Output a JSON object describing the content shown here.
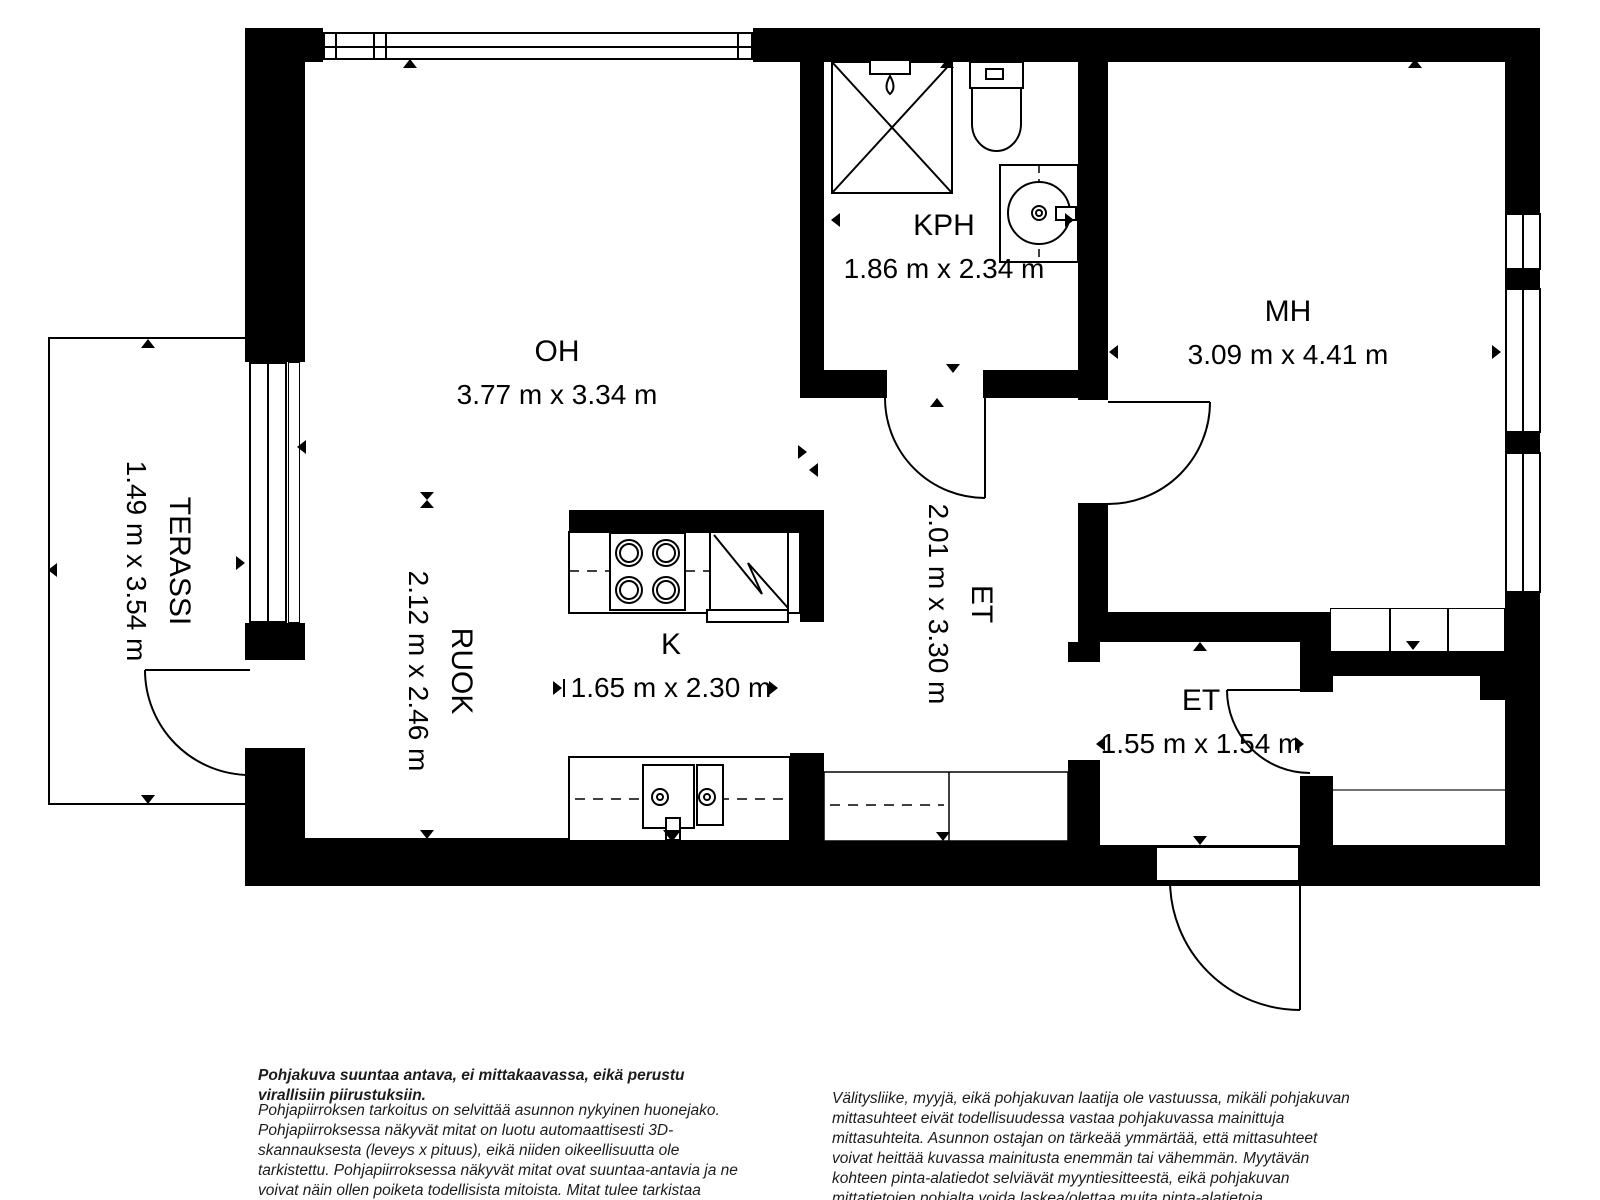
{
  "plan": {
    "rooms": {
      "oh": {
        "name": "OH",
        "dims": "3.77 m x 3.34 m"
      },
      "kph": {
        "name": "KPH",
        "dims": "1.86 m x 2.34 m"
      },
      "mh": {
        "name": "MH",
        "dims": "3.09 m x 4.41 m"
      },
      "terassi": {
        "name": "TERASSI",
        "dims": "1.49 m x 3.54 m"
      },
      "ruok": {
        "name": "RUOK",
        "dims": "2.12 m x 2.46 m"
      },
      "k": {
        "name": "K",
        "dims": "1.65 m x 2.30 m"
      },
      "et": {
        "name": "ET",
        "dims": "2.01 m x 3.30 m"
      },
      "et2": {
        "name": "ET",
        "dims": "1.55 m x 1.54 m"
      }
    },
    "fixtures": [
      "shower-icon",
      "toilet-icon",
      "washing-machine-icon",
      "stove-icon",
      "fridge-icon",
      "kitchen-sink-icon",
      "wardrobe-icon",
      "window-icon",
      "door-arc-icon",
      "measurement-triangle-icon"
    ],
    "colors": {
      "wall": "#000000",
      "background": "#ffffff",
      "line": "#000000"
    }
  },
  "notes": {
    "left_title": "Pohjakuva suuntaa antava, ei mittakaavassa, eikä perustu virallisiin piirustuksiin.",
    "left_body": "Pohjapiirroksen tarkoitus on selvittää asunnon nykyinen huonejako. Pohjapiirroksessa näkyvät mitat on luotu automaattisesti 3D-skannauksesta (leveys x pituus), eikä niiden oikeellisuutta ole tarkistettu. Pohjapiirroksessa näkyvät mitat ovat suuntaa-antavia ja ne voivat näin ollen poiketa todellisista mitoista. Mitat tulee tarkistaa esimerkiksi remonttia suunniteltaessa. Mittauskohdat on merkitty kuvaan pienillä kolmioilla.",
    "right_body": "Välitysliike, myyjä, eikä pohjakuvan laatija ole vastuussa, mikäli pohjakuvan mittasuhteet eivät todellisuudessa vastaa pohjakuvassa mainittuja mittasuhteita. Asunnon ostajan on tärkeää ymmärtää, että mittasuhteet voivat heittää kuvassa mainitusta enemmän tai vähemmän. Myytävän kohteen pinta-alatiedot selviävät myyntiesitteestä, eikä pohjakuvan mittatietojen pohjalta voida laskea/olettaa muita pinta-alatietoja."
  }
}
